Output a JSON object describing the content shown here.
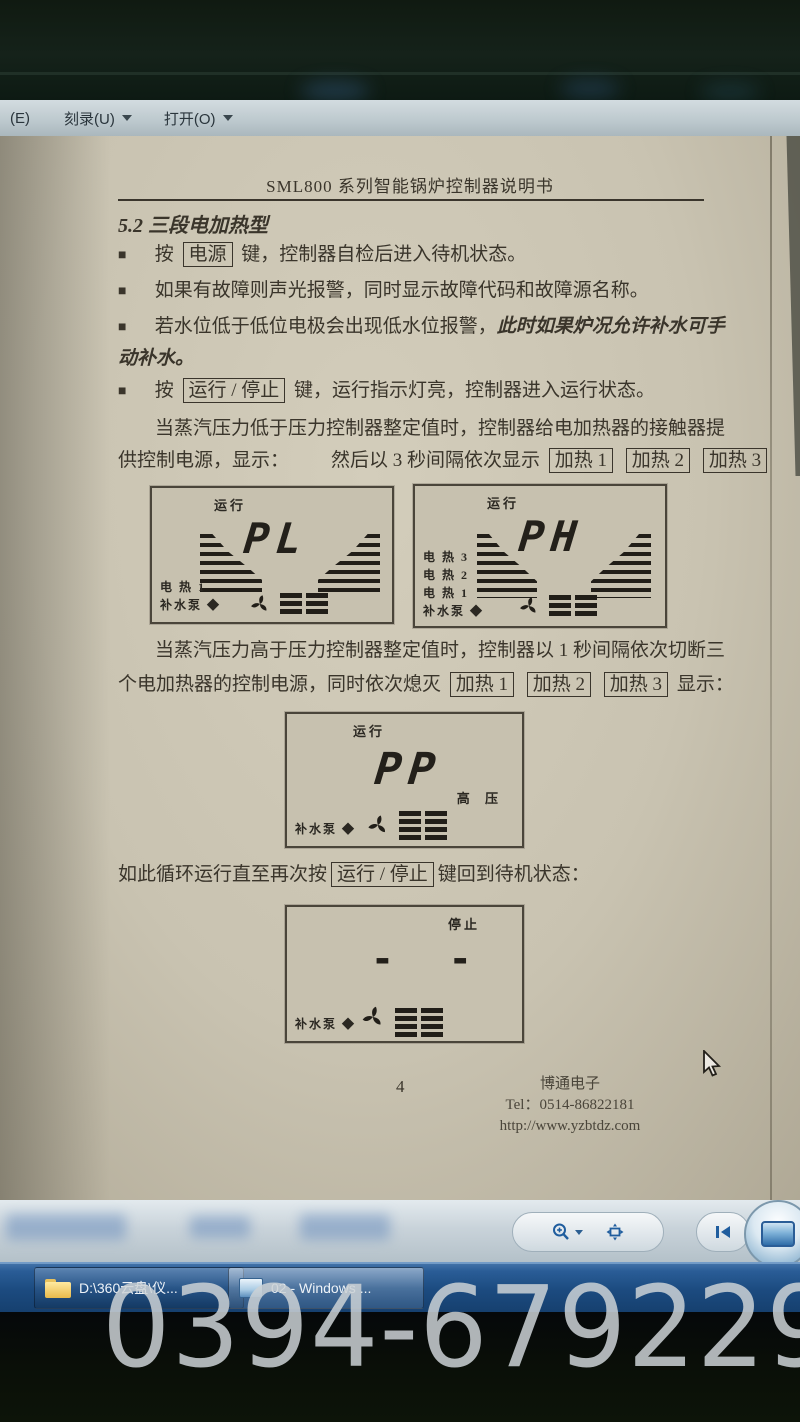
{
  "watermark": "0394-6792297",
  "colors": {
    "page_beige": "#c9c3b1",
    "taskbar_blue": "#2a5d97",
    "toolbar_icon_blue": "#1f5d9e",
    "ink": "#3a352b"
  },
  "menubar": {
    "partial_item": "(E)",
    "burn_label": "刻录(U)",
    "open_label": "打开(O)"
  },
  "doc": {
    "title": "SML800 系列智能锅炉控制器说明书",
    "heading": "5.2 三段电加热型",
    "bullet_marker": "■",
    "b1_pre": "按",
    "b1_key": "电源",
    "b1_post": "键，控制器自检后进入待机状态。",
    "b2": "如果有故障则声光报警，同时显示故障代码和故障源名称。",
    "b3": "若水位低于低位电极会出现低水位报警，",
    "b3_italic": "此时如果炉况允许补水可手",
    "b3_cont": "动补水。",
    "b4_pre": "按",
    "b4_key": "运行 / 停止",
    "b4_post": "键，运行指示灯亮，控制器进入运行状态。",
    "p1_line1": "当蒸汽压力低于压力控制器整定值时，控制器给电加热器的接触器提",
    "p1_line2_pre": "供控制电源，显示：",
    "p1_line2_mid": "然后以 3 秒间隔依次显示",
    "heat1": "加热 1",
    "heat2": "加热 2",
    "heat3": "加热 3",
    "p2_line1": "当蒸汽压力高于压力控制器整定值时，控制器以 1 秒间隔依次切断三",
    "p2_line2_pre": "个电加热器的控制电源，同时依次熄灭",
    "p2_line2_post": "显示：",
    "p3_pre": "如此循环运行直至再次按",
    "p3_key": "运行 / 停止",
    "p3_post": "键回到待机状态：",
    "footer_page": "4",
    "footer_company": "博通电子",
    "footer_tel": "Tel：0514-86822181",
    "footer_url": "http://www.yzbtdz.com"
  },
  "lcd": {
    "run_label": "运行",
    "stop_label": "停止",
    "pl": "PL",
    "ph": "PH",
    "pp": "PP",
    "dashes": "- -",
    "high_pressure": "高  压",
    "heat3": "电 热 3",
    "heat2": "电 热 2",
    "heat1": "电 热 1",
    "pump": "补水泵 ◆"
  },
  "taskbar": {
    "button1_label": "D:\\360云盘\\仪...",
    "button2_label": "02 - Windows ..."
  }
}
